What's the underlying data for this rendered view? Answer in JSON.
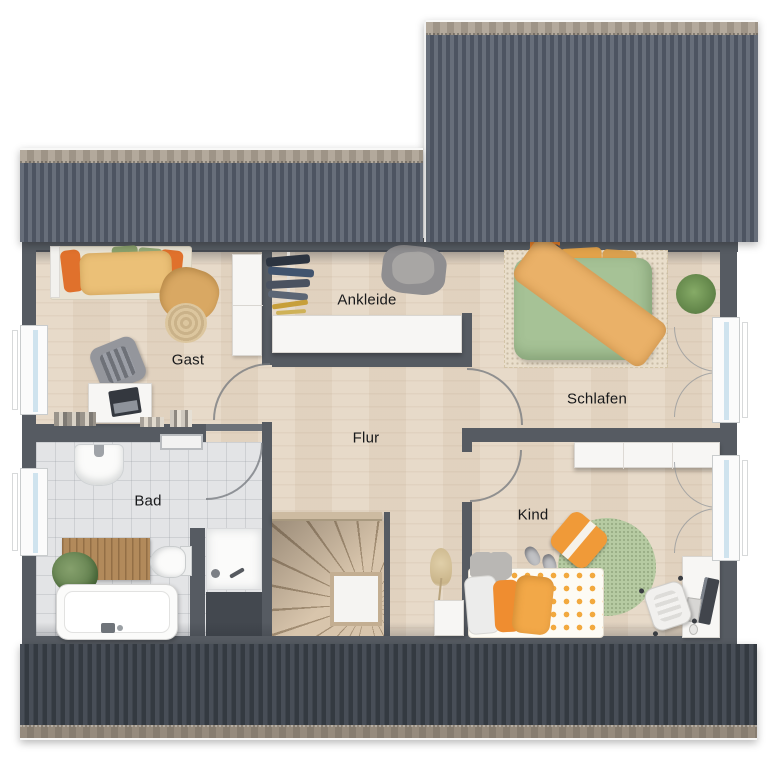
{
  "plan": {
    "title": "Dachgeschoss Grundriss",
    "rooms": [
      {
        "id": "gast",
        "label": "Gast"
      },
      {
        "id": "ankleide",
        "label": "Ankleide"
      },
      {
        "id": "schlafen",
        "label": "Schlafen"
      },
      {
        "id": "flur",
        "label": "Flur"
      },
      {
        "id": "bad",
        "label": "Bad"
      },
      {
        "id": "kind",
        "label": "Kind"
      }
    ]
  },
  "colors": {
    "wall": "#565b62",
    "roof_top_light": "#676e7a",
    "roof_top_dark": "#4d5461",
    "roof_bottom_light": "#484e57",
    "roof_bottom_dark": "#343a41",
    "ridge": "#a89e91",
    "floor_wood": "#e6d8c6",
    "floor_tile": "#e3e4e6",
    "accent_orange": "#e8953b",
    "accent_green": "#a9c49a",
    "label_text": "#17181a"
  }
}
